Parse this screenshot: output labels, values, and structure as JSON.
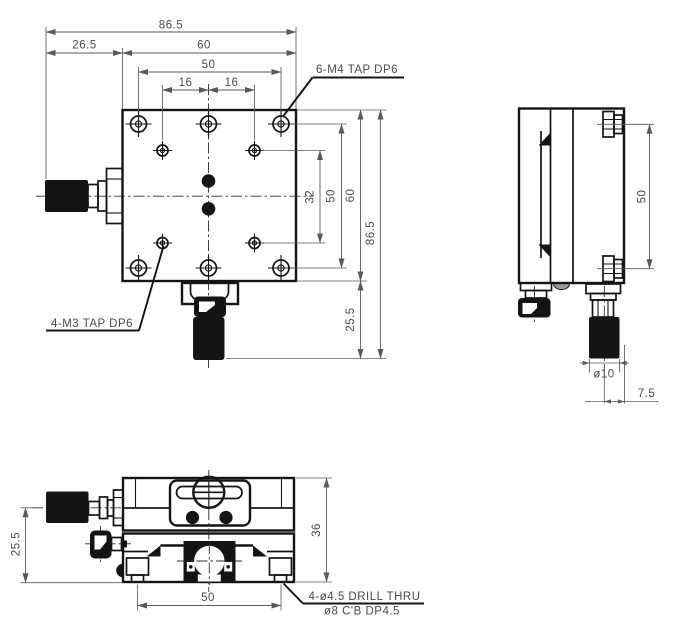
{
  "drawing": {
    "type": "engineering-drawing",
    "subject": "manual linear translation stage, three orthographic views",
    "colors": {
      "background": "#ffffff",
      "object_line": "#141414",
      "dimension_line": "#5a5a5a",
      "text": "#4a4a4a",
      "screw_fill": "#d8d8d8",
      "dome_fill": "#9a9a9a"
    }
  },
  "plan_view": {
    "dim_total_width": "86.5",
    "dim_knob_offset_left": "26.5",
    "dim_body_width": "60",
    "dim_hole_span_x": "50",
    "dim_hole_pitch_left": "16",
    "dim_hole_pitch_right": "16",
    "label_tap_m4": "6-M4 TAP DP6",
    "label_tap_m3": "4-M3 TAP DP6",
    "dim_inner_span_y": "32",
    "dim_hole_span_y": "50",
    "dim_body_height": "60",
    "dim_total_height": "86.5",
    "dim_knob_offset_bottom": "25.5"
  },
  "side_view": {
    "dim_hole_span_y": "50",
    "dim_knob_diameter": "ø10",
    "dim_knob_axis_offset": "7.5"
  },
  "front_view": {
    "dim_knob_axis_height": "25.5",
    "dim_body_height": "36",
    "dim_mount_hole_span": "50",
    "label_drill_thru": "4-ø4.5 DRILL THRU",
    "label_counterbore": "ø8 C'B DP4.5"
  }
}
